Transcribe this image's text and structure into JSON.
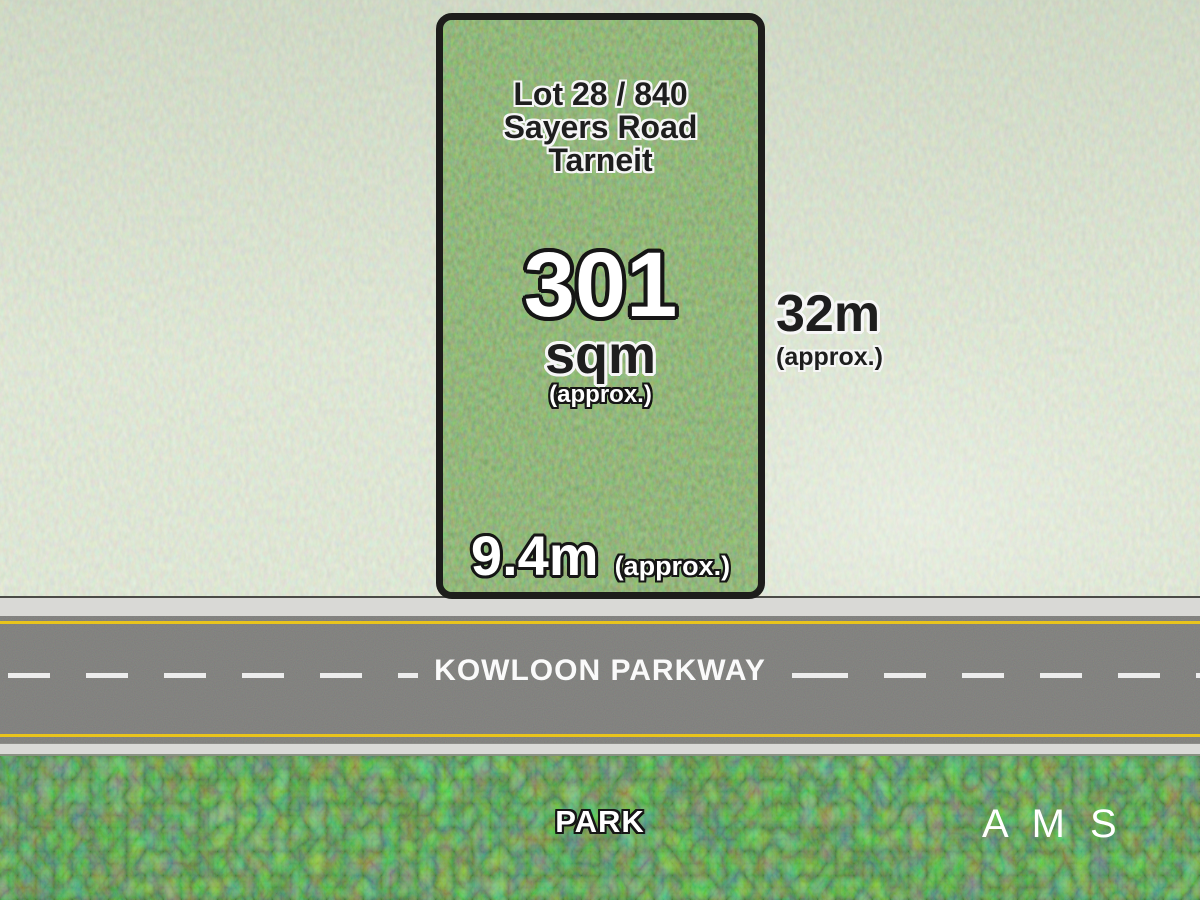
{
  "lot": {
    "address_line1": "Lot 28 / 840",
    "address_line2": "Sayers Road",
    "address_line3": "Tarneit",
    "area_value": "301",
    "area_unit": "sqm",
    "area_note": "(approx.)",
    "frontage_value": "9.4m",
    "frontage_note": "(approx.)",
    "depth_value": "32m",
    "depth_note": "(approx.)"
  },
  "road": {
    "name": "KOWLOON PARKWAY"
  },
  "park": {
    "label": "PARK"
  },
  "branding": {
    "logo_text": "A M S"
  },
  "colors": {
    "lot_grass": "#4c7a3a",
    "surrounding_grass": "#bcc9ab",
    "park_grass": "#2f7526",
    "asphalt": "#3a3a38",
    "sidewalk": "#d9d9d6",
    "lane_marking_white": "#ededed",
    "edge_line_yellow": "#e9c41c",
    "lot_border": "#1d1d1b",
    "text_dark": "#1e1e1e",
    "text_light": "#ffffff"
  }
}
